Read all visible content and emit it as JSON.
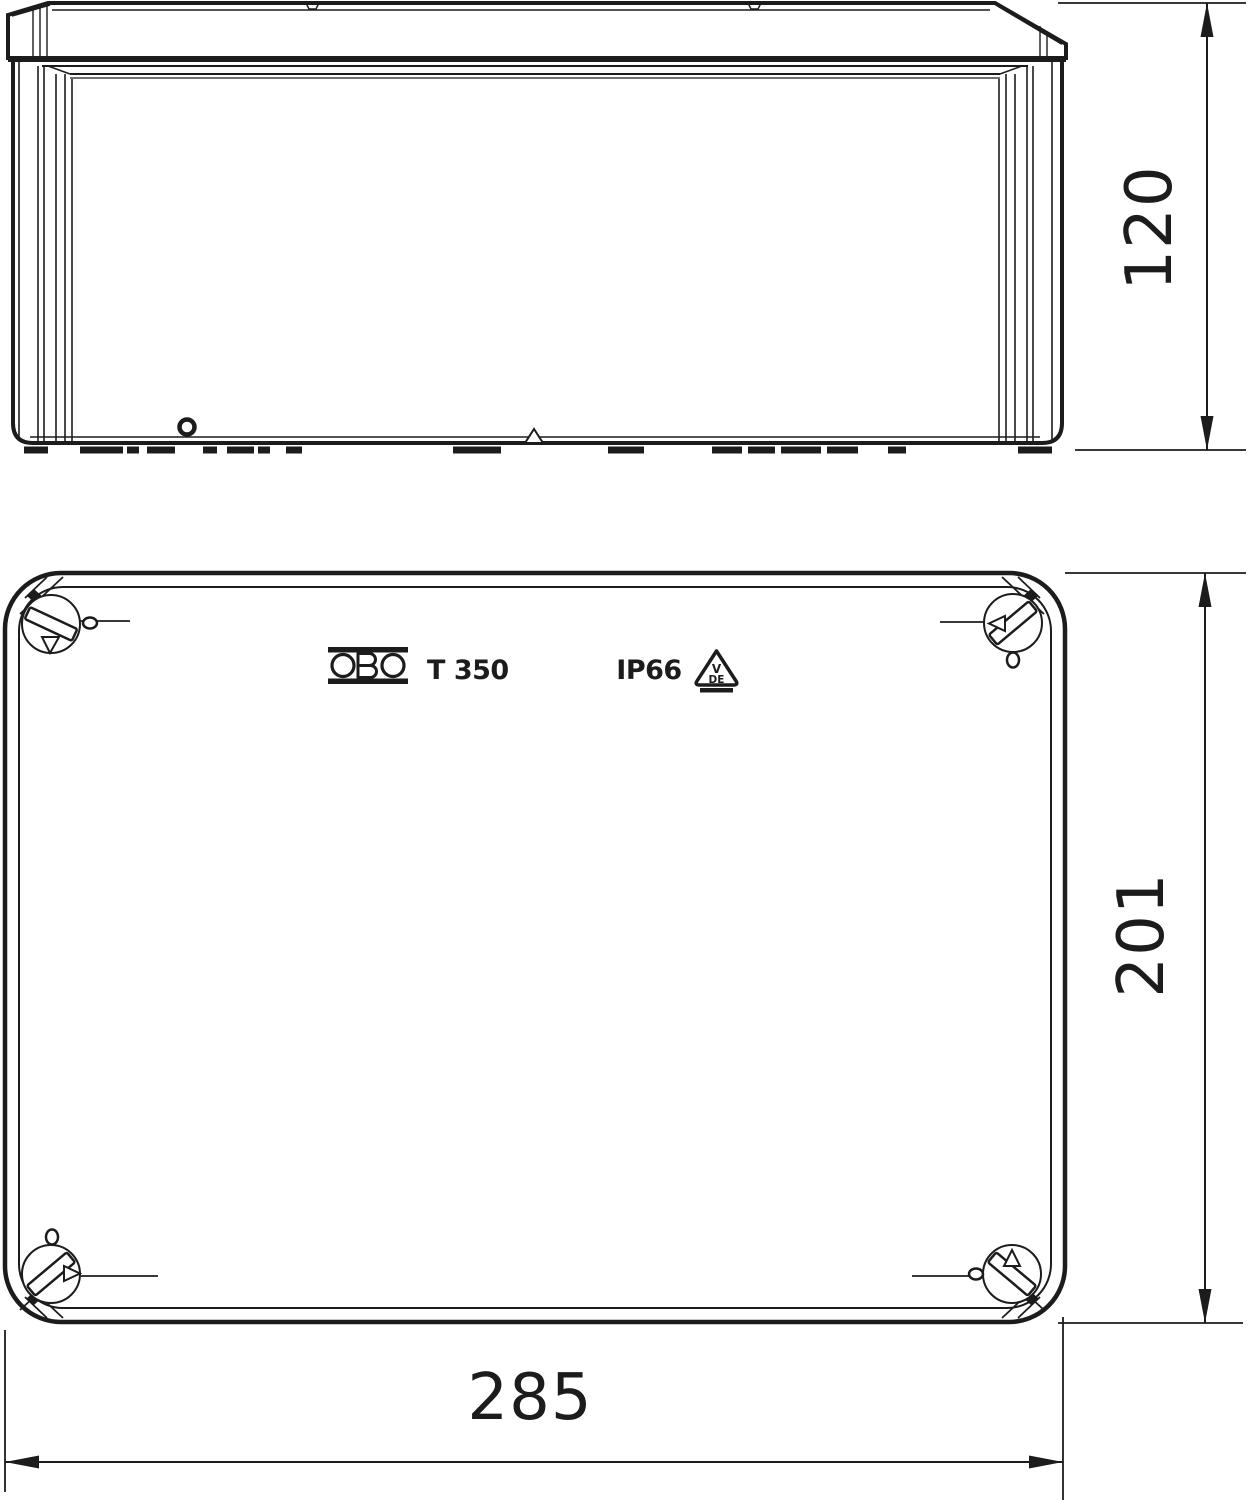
{
  "brand": {
    "name": "OBO"
  },
  "product": {
    "model": "T 350",
    "ip_rating": "IP66"
  },
  "vde_mark": {
    "top": "V",
    "bottom": "DE"
  },
  "dimensions": {
    "height_mm": "120",
    "depth_mm": "201",
    "width_mm": "285"
  },
  "colors": {
    "line": "#1c1c1c",
    "background": "#ffffff"
  }
}
